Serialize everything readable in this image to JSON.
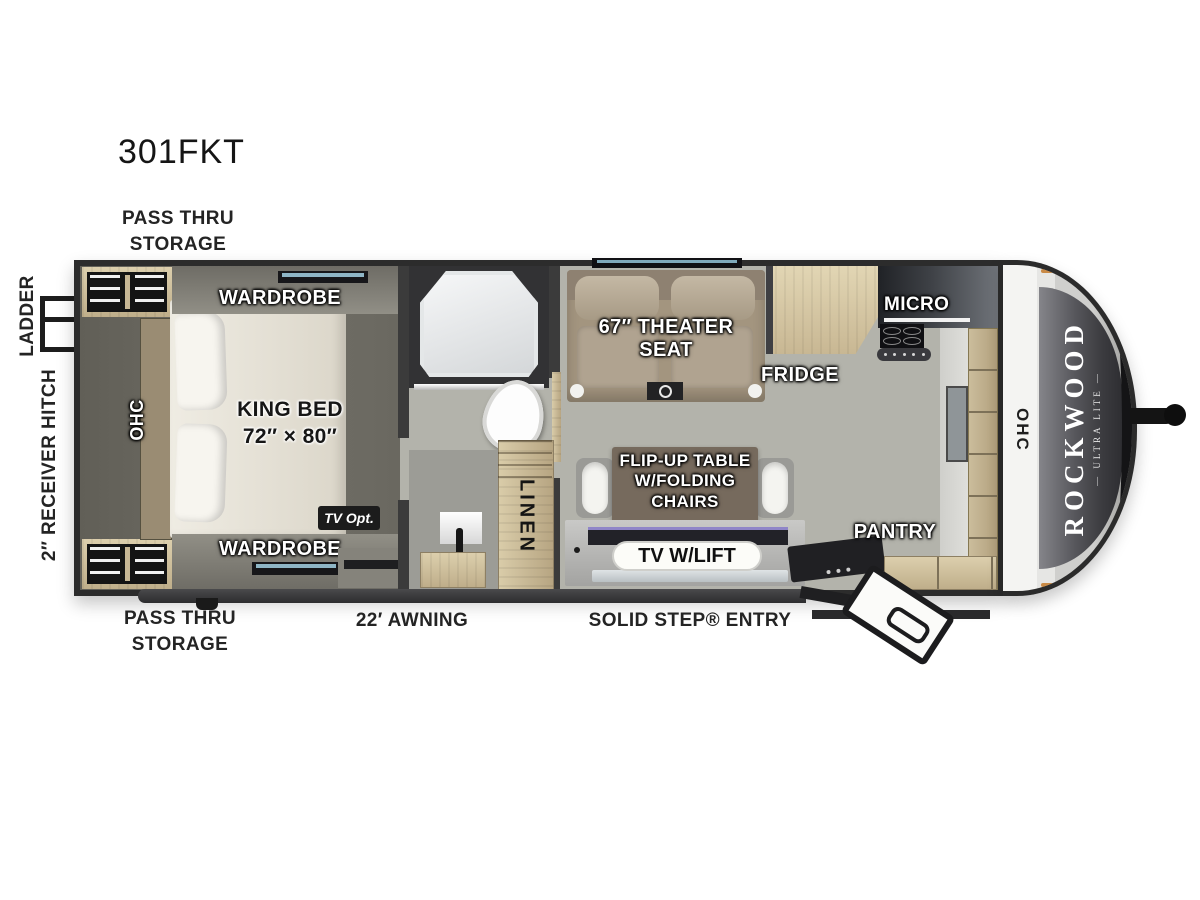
{
  "title": "301FKT",
  "exterior": {
    "pass_thru_top": "PASS THRU\nSTORAGE",
    "pass_thru_bottom": "PASS THRU\nSTORAGE",
    "ladder": "LADDER",
    "receiver_hitch": "2″ RECEIVER HITCH",
    "awning": "22′ AWNING",
    "entry": "SOLID STEP® ENTRY"
  },
  "bedroom": {
    "wardrobe_top": "WARDROBE",
    "wardrobe_bottom": "WARDROBE",
    "ohc": "OHC",
    "king_bed": "KING BED\n72″ × 80″",
    "tv_opt": "TV Opt."
  },
  "bathroom": {
    "linen": "LINEN"
  },
  "living": {
    "theater_seat": "67″ THEATER\nSEAT",
    "fridge": "FRIDGE",
    "micro": "MICRO",
    "flip_table": "FLIP-UP TABLE\nW/FOLDING\nCHAIRS",
    "tv_lift": "TV W/LIFT",
    "pantry": "PANTRY",
    "ohc": "OHC"
  },
  "brand": {
    "name": "ROCKWOOD",
    "sub": "— ULTRA LITE —"
  },
  "colors": {
    "wall": "#2c2c2c",
    "floor_main": "#b3b3ab",
    "floor_bedroom": "#6a6860",
    "wood": "#d3c3a0",
    "cap_dark": "#46464a",
    "accent_window": "#8fb6c6"
  }
}
